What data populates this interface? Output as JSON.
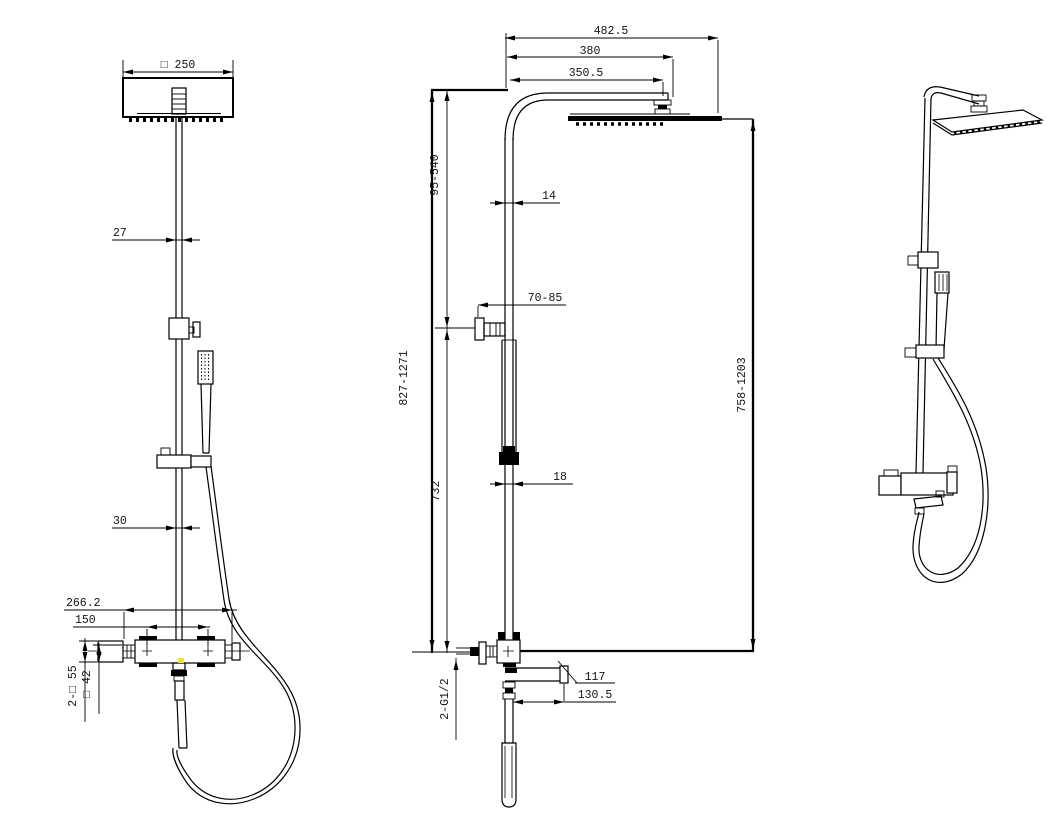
{
  "drawing": {
    "background": "#ffffff",
    "line_color": "#000000",
    "highlight_color": "#efe23a",
    "front_view": {
      "dims": {
        "head_size": "□ 250",
        "pole_width": "27",
        "lower_pole_width": "30",
        "valve_overall": "266.2",
        "handle_spacing": "150",
        "handle_size": "2-□ 55",
        "valve_body": "□ 42"
      }
    },
    "side_view": {
      "dims": {
        "arm_overall": "482.5",
        "head_center": "380",
        "arm_length": "350.5",
        "head_drop_range": "95-540",
        "upper_pipe_dia": "14",
        "bracket_depth": "70-85",
        "overall_height": "827-1271",
        "lower_section": "732",
        "head_to_outlet": "758-1203",
        "lower_pipe_dia": "18",
        "spout_reach": "117",
        "spout_overall": "130.5",
        "inlet_threads": "2-G1/2"
      }
    }
  }
}
